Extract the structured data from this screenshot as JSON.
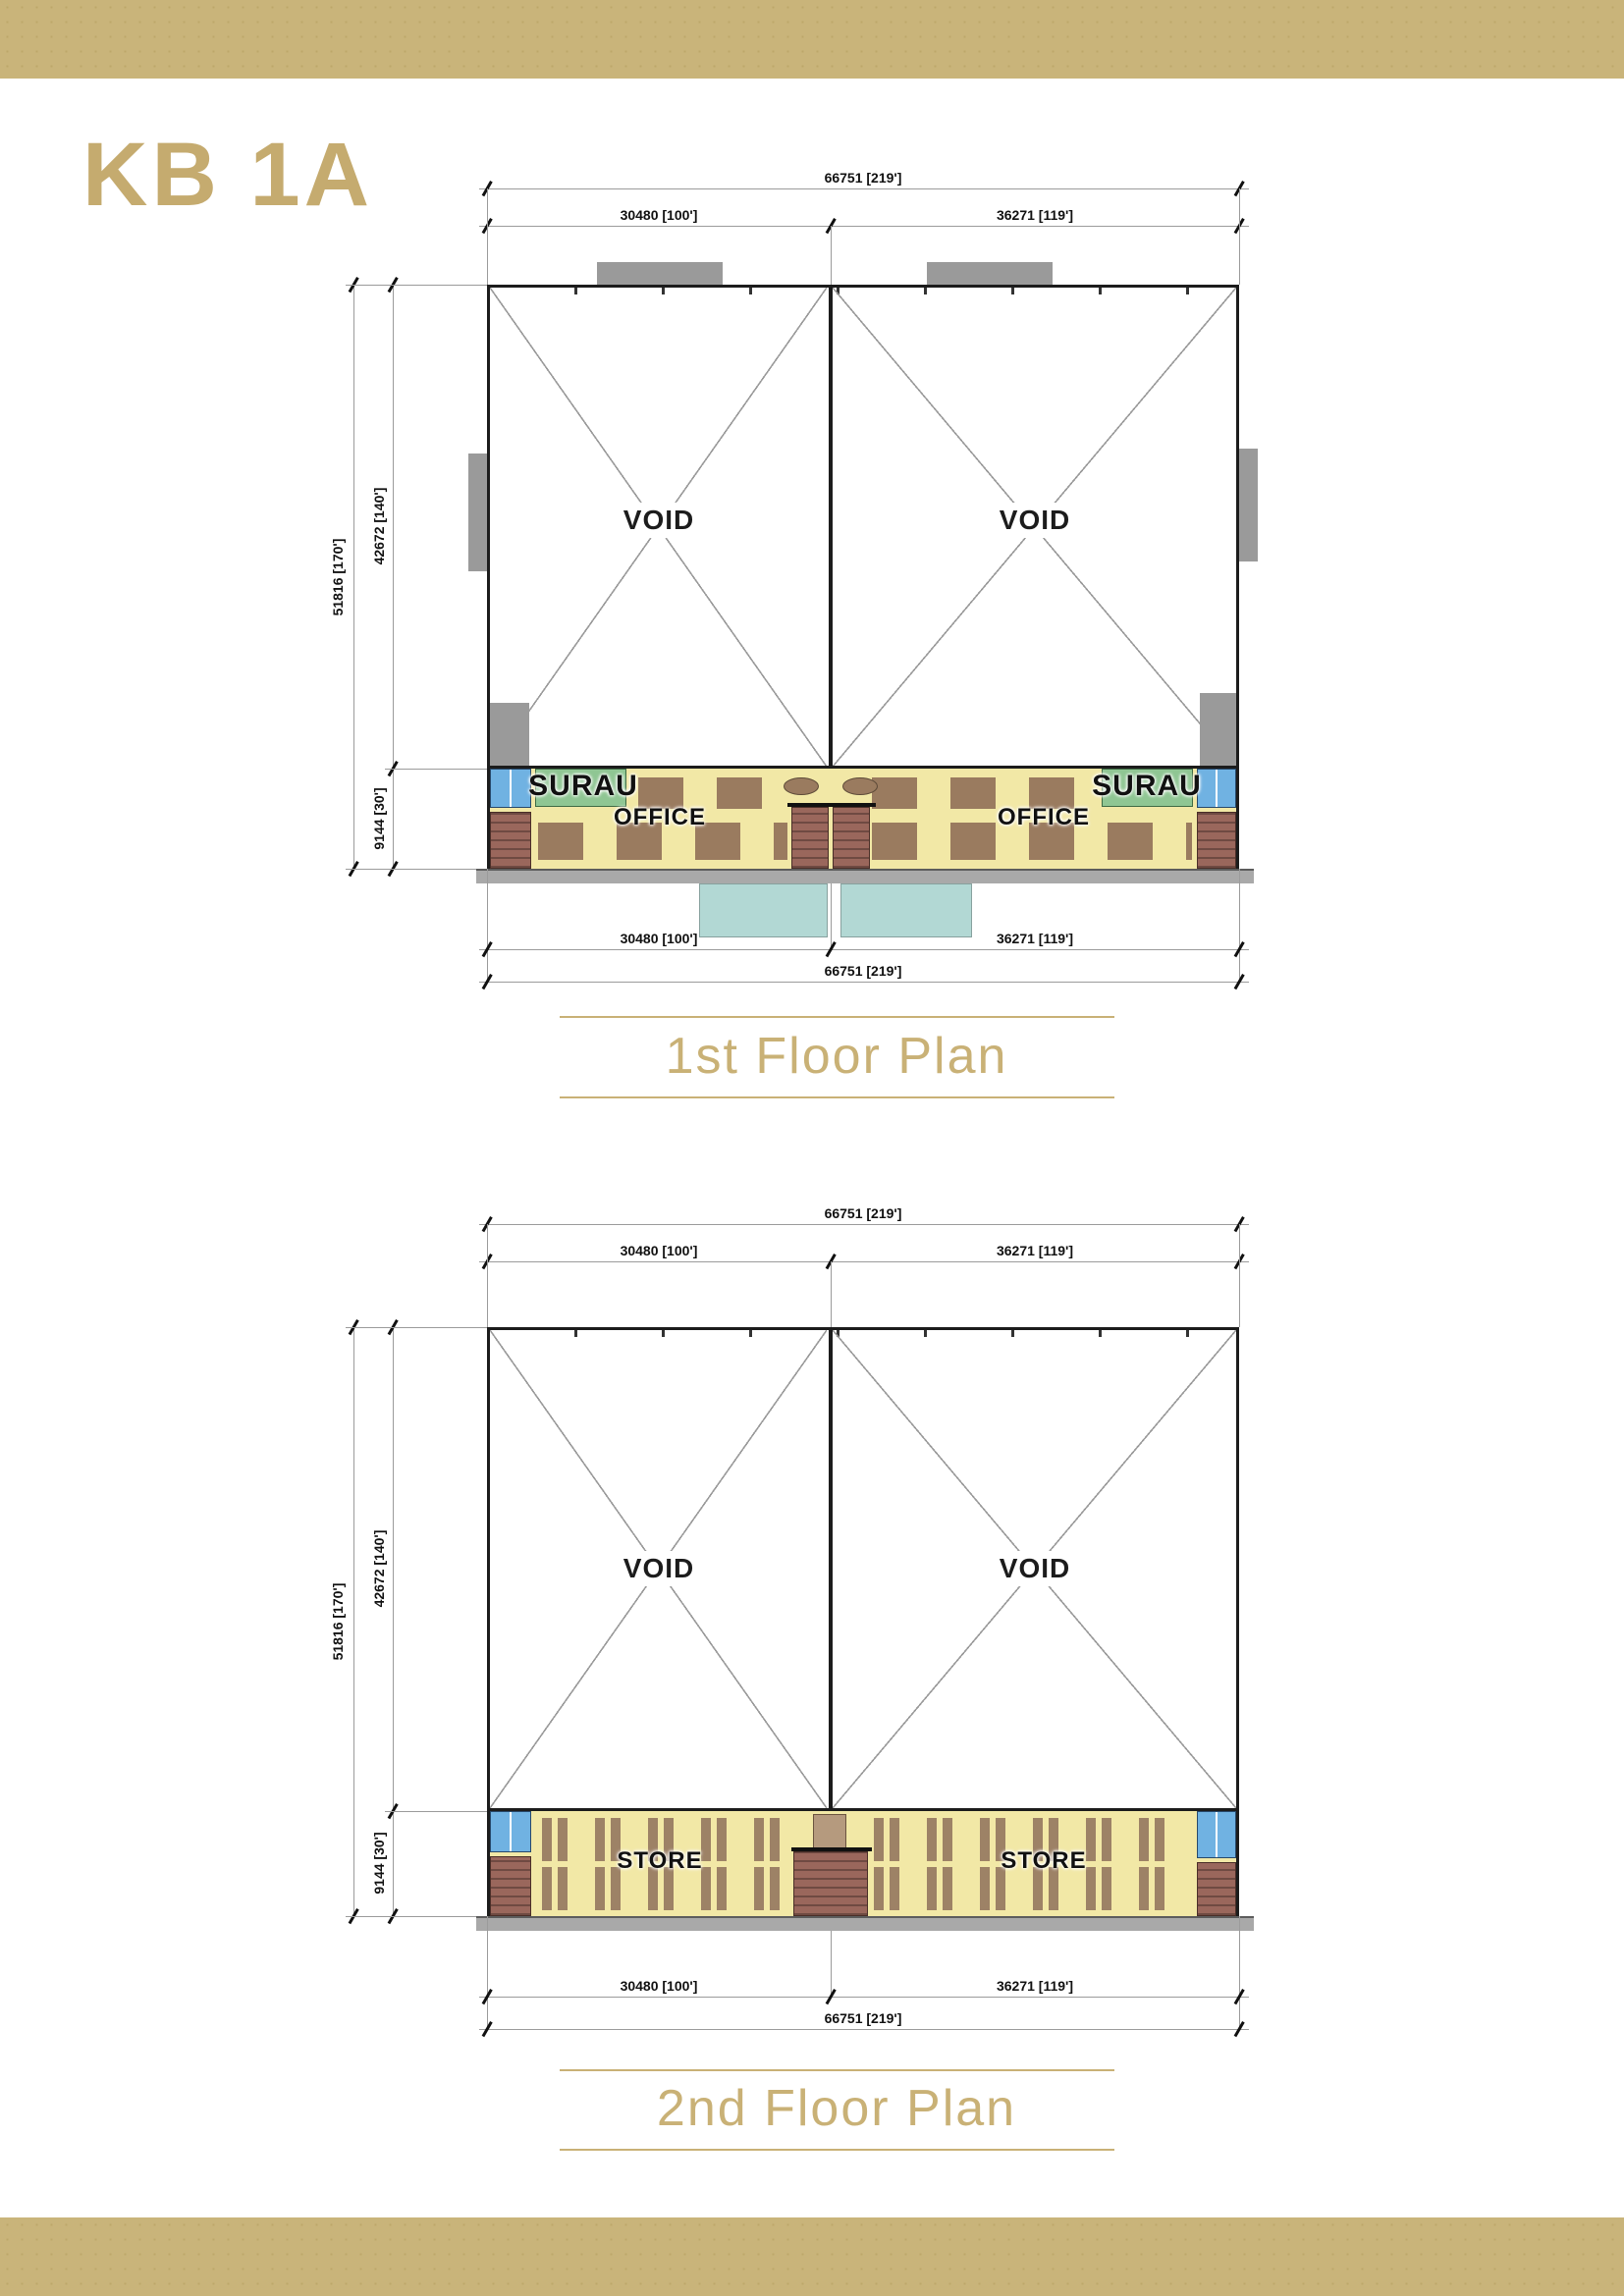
{
  "page": {
    "code": "KB 1A"
  },
  "plans": [
    {
      "title": "1st Floor Plan",
      "dims": {
        "overall_width": "66751 [219']",
        "left_bay_width": "30480 [100']",
        "right_bay_width": "36271 [119']",
        "overall_depth": "51816 [170']",
        "void_depth": "42672 [140']",
        "front_depth": "9144 [30']"
      },
      "rooms": {
        "void_left": "VOID",
        "void_right": "VOID",
        "surau_left": "SURAU",
        "surau_right": "SURAU",
        "office_left": "OFFICE",
        "office_right": "OFFICE"
      }
    },
    {
      "title": "2nd Floor Plan",
      "dims": {
        "overall_width": "66751 [219']",
        "left_bay_width": "30480 [100']",
        "right_bay_width": "36271 [119']",
        "overall_depth": "51816 [170']",
        "void_depth": "42672 [140']",
        "front_depth": "9144 [30']"
      },
      "rooms": {
        "void_left": "VOID",
        "void_right": "VOID",
        "store_left": "STORE",
        "store_right": "STORE"
      }
    }
  ],
  "colors": {
    "accent_gold": "#c9b47a",
    "title_gold": "#c9b176",
    "floor_yellow": "#f2e8a6",
    "surau_green": "#8fc693",
    "toilet_blue": "#70b2e2",
    "stair_maroon": "#9a675c",
    "canopy_teal": "#b2d8d4",
    "wall_black": "#1c1c1c"
  }
}
